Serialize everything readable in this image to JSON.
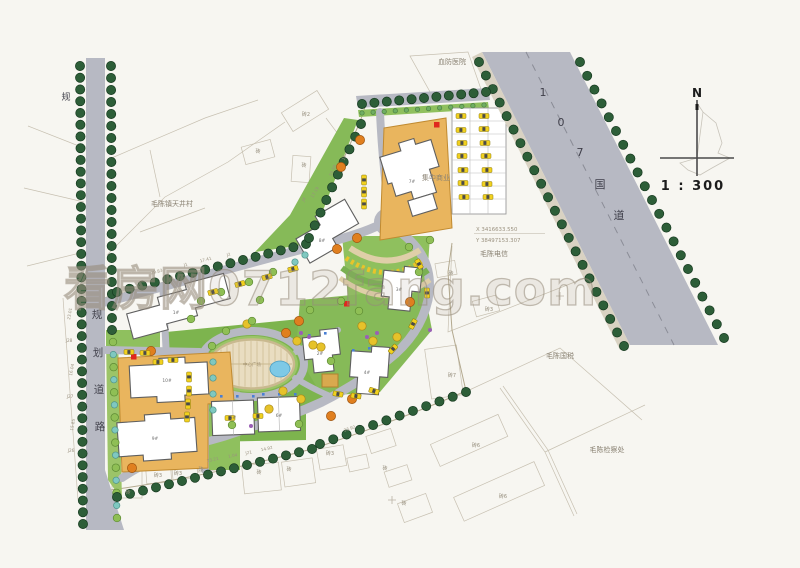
{
  "compass": {
    "north_label": "N",
    "scale_label": "1 : 300"
  },
  "watermark": {
    "text": "看房网0712fang.com"
  },
  "coordinate_marker": {
    "x_label": "X  3416633.550",
    "y_label": "Y  38497153.307"
  },
  "roads": {
    "planned_road_west_char": "规",
    "national_road_name_chars": [
      {
        "text": "1",
        "x": 543,
        "y": 96
      },
      {
        "text": "0",
        "x": 561,
        "y": 126
      },
      {
        "text": "7",
        "x": 580,
        "y": 156
      },
      {
        "text": "国",
        "x": 600,
        "y": 188
      },
      {
        "text": "道",
        "x": 619,
        "y": 219
      }
    ],
    "planned_road_name_chars": [
      {
        "text": "规",
        "x": 97,
        "y": 318
      },
      {
        "text": "划",
        "x": 98,
        "y": 356
      },
      {
        "text": "道",
        "x": 99,
        "y": 393
      },
      {
        "text": "路",
        "x": 100,
        "y": 430
      }
    ]
  },
  "places": [
    {
      "name": "hospital",
      "text": "血防医院",
      "x": 452,
      "y": 64
    },
    {
      "name": "village",
      "text": "毛陈镇天井村",
      "x": 172,
      "y": 206
    },
    {
      "name": "telecom",
      "text": "毛陈电信",
      "x": 494,
      "y": 256
    },
    {
      "name": "tax-office",
      "text": "毛陈国税",
      "x": 560,
      "y": 358
    },
    {
      "name": "procuratorate",
      "text": "毛陈检察处",
      "x": 607,
      "y": 452
    },
    {
      "name": "commercial",
      "text": "集中商业",
      "x": 436,
      "y": 180
    },
    {
      "name": "central-plaza",
      "text": "中心广场",
      "x": 252,
      "y": 366
    }
  ],
  "parcel_labels": [
    {
      "text": "砖2",
      "x": 306,
      "y": 116
    },
    {
      "text": "砖",
      "x": 258,
      "y": 153
    },
    {
      "text": "砖",
      "x": 304,
      "y": 167
    },
    {
      "text": "砖",
      "x": 451,
      "y": 275
    },
    {
      "text": "砖3",
      "x": 489,
      "y": 311
    },
    {
      "text": "砖7",
      "x": 452,
      "y": 377
    },
    {
      "text": "砖6",
      "x": 476,
      "y": 447
    },
    {
      "text": "砖6",
      "x": 503,
      "y": 498
    },
    {
      "text": "砖",
      "x": 128,
      "y": 494
    },
    {
      "text": "砖3",
      "x": 158,
      "y": 477
    },
    {
      "text": "砖3",
      "x": 178,
      "y": 475
    },
    {
      "text": "砖",
      "x": 201,
      "y": 471
    },
    {
      "text": "砖",
      "x": 259,
      "y": 474
    },
    {
      "text": "砖",
      "x": 289,
      "y": 471
    },
    {
      "text": "砖3",
      "x": 330,
      "y": 455
    },
    {
      "text": "砖",
      "x": 385,
      "y": 470
    },
    {
      "text": "砖",
      "x": 404,
      "y": 505
    }
  ],
  "survey_labels": [
    {
      "text": "29.83",
      "x": 157,
      "y": 273,
      "rot": -15
    },
    {
      "text": "J1",
      "x": 186,
      "y": 266,
      "rot": -15
    },
    {
      "text": "17.41",
      "x": 206,
      "y": 261,
      "rot": -15
    },
    {
      "text": "J2",
      "x": 229,
      "y": 256,
      "rot": -15
    },
    {
      "text": "16.50",
      "x": 334,
      "y": 171,
      "rot": -65
    },
    {
      "text": "J3",
      "x": 345,
      "y": 158,
      "rot": -65
    },
    {
      "text": "17.19",
      "x": 316,
      "y": 193,
      "rot": -60
    },
    {
      "text": "J4",
      "x": 305,
      "y": 200,
      "rot": -60
    },
    {
      "text": "23.01",
      "x": 71,
      "y": 314,
      "rot": -80
    },
    {
      "text": "J28",
      "x": 69,
      "y": 342,
      "rot": 0
    },
    {
      "text": "16.04",
      "x": 73,
      "y": 370,
      "rot": -80
    },
    {
      "text": "J27",
      "x": 70,
      "y": 398,
      "rot": 0
    },
    {
      "text": "15.85",
      "x": 74,
      "y": 425,
      "rot": -80
    },
    {
      "text": "J26",
      "x": 71,
      "y": 452,
      "rot": 0
    },
    {
      "text": "23.21",
      "x": 213,
      "y": 461,
      "rot": -12
    },
    {
      "text": "1.04",
      "x": 233,
      "y": 457,
      "rot": -12
    },
    {
      "text": "J21",
      "x": 249,
      "y": 454,
      "rot": -12
    },
    {
      "text": "14.92",
      "x": 267,
      "y": 450,
      "rot": -12
    },
    {
      "text": "33.92",
      "x": 350,
      "y": 430,
      "rot": -18
    }
  ],
  "building_labels": [
    {
      "text": "1#",
      "x": 176,
      "y": 314
    },
    {
      "text": "2#",
      "x": 320,
      "y": 355
    },
    {
      "text": "3#",
      "x": 399,
      "y": 291
    },
    {
      "text": "4#",
      "x": 367,
      "y": 374
    },
    {
      "text": "5#",
      "x": 233,
      "y": 419
    },
    {
      "text": "6#",
      "x": 279,
      "y": 417
    },
    {
      "text": "7#",
      "x": 412,
      "y": 183
    },
    {
      "text": "8#",
      "x": 322,
      "y": 242
    },
    {
      "text": "9#",
      "x": 155,
      "y": 440
    },
    {
      "text": "10#",
      "x": 167,
      "y": 382
    }
  ],
  "colors": {
    "background": "#f7f6f1",
    "road": "#b7b9c3",
    "sidewalk": "#d9d2c2",
    "podium": "#e9b55e",
    "grass": "#7db44e",
    "tree_dark": "#2d5e38",
    "water": "#7ec9e6",
    "car": "#f2d11e",
    "marker_red": "#e0281e"
  }
}
